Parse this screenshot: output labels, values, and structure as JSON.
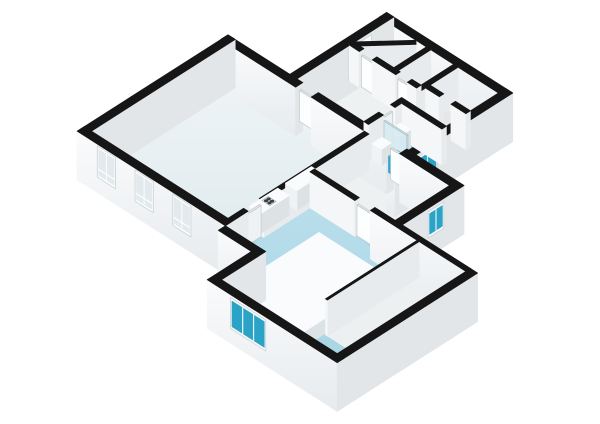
{
  "scene": {
    "w": 600,
    "h": 424,
    "origin": [
      228,
      80
    ],
    "ux": 13,
    "uy": 8.3,
    "wall_z": 36
  },
  "palette": {
    "cap": "#161616",
    "ext_u": "#e2e6e9",
    "ext_v": "@gext",
    "int_u": "#e7ebed",
    "int_v": "#f4f6f7",
    "furn_top": "#fafbfc",
    "furn_u": "#dde2e5",
    "furn_v": "#f0f3f4",
    "door_top": "#e8edef",
    "door_u": "#eef2f3",
    "door_v": "#fdfefe",
    "glass_top": "#d6e6ec",
    "glass_u": "rgba(196,223,233,0.9)",
    "glass_v": "rgba(214,234,241,0.9)",
    "teal_top": "#45b2cf",
    "teal_u": "#1d84a2",
    "teal_v": "#2ea7c9",
    "frame": "#fcfdfd",
    "frame_shade": "#c9d1d5",
    "glass_teal": "#2aa3c6",
    "glass_pale": "#e3eaed",
    "glass_bright": "#f7fafb",
    "floor_living": "@gliv",
    "floor_blue": "@gblue",
    "floor_hall": "#eef1f2",
    "floor_room": "#e4e8ea",
    "floor_room2": "#e9eced",
    "floor_bath": "#43acca",
    "floor_shower": "#66c0d8",
    "floor_closet": "#edf0f1",
    "stove_body": "#f2f4f4",
    "stove_dot": "#3a4043",
    "stove_edge": "#9aa4a8"
  },
  "floors": [
    {
      "n": "floor-living-room",
      "r": [
        0,
        0,
        10.5,
        10.5
      ],
      "f": "floor_living"
    },
    {
      "n": "floor-cluster-hall",
      "r": [
        4.75,
        -4.6,
        9.9,
        -0.55
      ],
      "f": "floor_hall"
    },
    {
      "n": "floor-room-topleft",
      "r": [
        4.75,
        -7.45,
        7.8,
        -4.95
      ],
      "f": "floor_room"
    },
    {
      "n": "floor-room-mid",
      "r": [
        8.15,
        -7.45,
        9.9,
        -4.95
      ],
      "f": "floor_room2"
    },
    {
      "n": "floor-closet-1",
      "r": [
        10.25,
        -7.45,
        13.35,
        -5.3
      ],
      "f": "floor_room"
    },
    {
      "n": "floor-closet-2",
      "r": [
        10.25,
        -4.95,
        13.35,
        -3.45
      ],
      "f": "floor_room2"
    },
    {
      "n": "floor-bathroom",
      "r": [
        10.25,
        -3.1,
        13.35,
        -0.55
      ],
      "f": "floor_bath"
    },
    {
      "n": "floor-shower",
      "r": [
        10.25,
        -3.1,
        13.35,
        -1.8
      ],
      "f": "floor_shower"
    },
    {
      "n": "floor-hallway-east",
      "r": [
        10.85,
        0,
        17.05,
        4.2
      ],
      "f": "floor_hall"
    },
    {
      "n": "floor-bedroom",
      "poly": [
        [
          10.85,
          4.55
        ],
        [
          22.85,
          4.55
        ],
        [
          22.85,
          14.45
        ],
        [
          13.95,
          14.45
        ],
        [
          13.95,
          11.05
        ],
        [
          10.85,
          11.05
        ]
      ],
      "f": "floor_blue"
    },
    {
      "n": "floor-closet-bedroom",
      "r": [
        19.25,
        4.55,
        22.85,
        11.6
      ],
      "f": "floor_closet"
    },
    {
      "n": "threshold",
      "r": [
        5.2,
        -0.55,
        6.4,
        0
      ],
      "f": "floor_hall"
    },
    {
      "n": "threshold",
      "r": [
        12.2,
        -0.55,
        13.2,
        0
      ],
      "f": "floor_bath"
    },
    {
      "n": "threshold",
      "r": [
        10.5,
        8.1,
        10.85,
        9.3
      ],
      "f": "floor_blue"
    },
    {
      "n": "threshold",
      "r": [
        14.3,
        4.2,
        15.5,
        4.55
      ],
      "f": "floor_blue"
    },
    {
      "n": "threshold",
      "r": [
        9.9,
        -2.6,
        10.25,
        -1.7
      ],
      "f": "floor_bath"
    },
    {
      "n": "threshold",
      "r": [
        5.5,
        -4.95,
        6.5,
        -4.6
      ],
      "f": "floor_hall"
    },
    {
      "n": "threshold",
      "r": [
        8.3,
        -4.95,
        9.2,
        -4.6
      ],
      "f": "floor_hall"
    },
    {
      "n": "threshold",
      "r": [
        11.3,
        -5.3,
        12.2,
        -4.95
      ],
      "f": "floor_room2"
    }
  ],
  "boxes": [
    {
      "n": "wall-north-living",
      "k": "ext",
      "r": [
        -0.55,
        -0.55,
        5.2,
        0
      ],
      "zb": -0.35
    },
    {
      "n": "wall-north-living-2",
      "k": "ext",
      "r": [
        6.4,
        -0.55,
        12.2,
        0
      ],
      "zb": -0.35
    },
    {
      "n": "wall-north-east",
      "k": "ext",
      "r": [
        13.2,
        -0.55,
        17.6,
        0
      ],
      "zb": -0.35
    },
    {
      "n": "wall-west-living",
      "k": "ext",
      "r": [
        -0.55,
        -0.55,
        0,
        11.05
      ],
      "zb": -0.35
    },
    {
      "n": "wall-south-living",
      "k": "ext",
      "r": [
        -0.55,
        10.5,
        10.85,
        11.05
      ],
      "zb": -0.35,
      "decals": [
        {
          "t": "win",
          "pl": "v",
          "at": 11.05,
          "a": [
            1.0,
            2.4
          ],
          "z": [
            0.08,
            0.95
          ],
          "g": "glass_pale",
          "panes": 2,
          "rail": 1
        },
        {
          "t": "win",
          "pl": "v",
          "at": 11.05,
          "a": [
            3.9,
            5.3
          ],
          "z": [
            0.08,
            0.95
          ],
          "g": "glass_pale",
          "panes": 2,
          "rail": 1
        },
        {
          "t": "win",
          "pl": "v",
          "at": 11.05,
          "a": [
            6.8,
            8.2
          ],
          "z": [
            0.08,
            0.95
          ],
          "g": "glass_pale",
          "panes": 2,
          "rail": 1
        }
      ]
    },
    {
      "n": "wall-east-living",
      "k": "int",
      "r": [
        10.5,
        0,
        10.85,
        8.1
      ]
    },
    {
      "n": "wall-east-living-2",
      "k": "int",
      "r": [
        10.5,
        9.3,
        10.85,
        11.05
      ]
    },
    {
      "n": "wall-cluster-north",
      "k": "ext",
      "r": [
        4.2,
        -8,
        13.9,
        -7.45
      ],
      "zb": -0.35
    },
    {
      "n": "wall-cluster-west",
      "k": "ext",
      "r": [
        4.2,
        -8,
        4.75,
        0
      ],
      "zb": -0.35,
      "decals": [
        {
          "t": "win",
          "pl": "u",
          "at": 4.75,
          "a": [
            -6.3,
            -4.5
          ],
          "z": [
            0.05,
            0.9
          ],
          "g": "glass_bright",
          "panes": 2
        }
      ]
    },
    {
      "n": "wall-cluster-east",
      "k": "ext",
      "r": [
        13.35,
        -8,
        13.9,
        1.1
      ],
      "zb": -0.35,
      "decals": [
        {
          "t": "win",
          "pl": "u",
          "at": 13.9,
          "a": [
            -2.2,
            -0.7
          ],
          "z": [
            0.18,
            0.9
          ],
          "g": "glass_teal",
          "panes": 2
        }
      ]
    },
    {
      "n": "wall-hall-east",
      "k": "ext",
      "r": [
        17.05,
        0,
        17.6,
        4.2
      ],
      "zb": -0.35,
      "decals": [
        {
          "t": "win",
          "pl": "u",
          "at": 17.6,
          "a": [
            1.0,
            2.2
          ],
          "z": [
            0.18,
            0.9
          ],
          "g": "glass_teal",
          "panes": 2
        }
      ]
    },
    {
      "n": "wall-bedroom-north",
      "k": "int",
      "r": [
        10.85,
        4.2,
        14.3,
        4.55
      ]
    },
    {
      "n": "wall-bedroom-north-2",
      "k": "ext",
      "r": [
        15.5,
        4.2,
        22.85,
        4.55
      ],
      "zb": -0.35
    },
    {
      "n": "wall-bedroom-east",
      "k": "ext",
      "r": [
        22.85,
        4.2,
        23.4,
        15
      ],
      "zb": -0.35
    },
    {
      "n": "wall-bedroom-south",
      "k": "ext",
      "r": [
        13.4,
        14.45,
        23.4,
        15
      ],
      "zb": -0.35,
      "decals": [
        {
          "t": "win",
          "pl": "v",
          "at": 15,
          "a": [
            15.2,
            17.9
          ],
          "z": [
            0.06,
            0.92
          ],
          "g": "glass_teal",
          "panes": 3
        }
      ]
    },
    {
      "n": "wall-step-south",
      "k": "ext",
      "r": [
        10.85,
        11.05,
        13.95,
        11.6
      ],
      "zb": -0.35
    },
    {
      "n": "wall-step-west",
      "k": "ext",
      "r": [
        13.4,
        11.6,
        13.95,
        14.45
      ],
      "zb": -0.35
    },
    {
      "n": "wall-closet-a",
      "k": "int",
      "r": [
        7.8,
        -7.45,
        8.15,
        -4.95
      ]
    },
    {
      "n": "wall-diagonal",
      "k": "int",
      "poly": [
        [
          4.75,
          -5.0
        ],
        [
          7.0,
          -7.45
        ],
        [
          7.26,
          -7.21
        ],
        [
          5.01,
          -4.76
        ]
      ]
    },
    {
      "n": "wall-closet-b1",
      "k": "int",
      "r": [
        4.75,
        -4.95,
        5.5,
        -4.6
      ]
    },
    {
      "n": "wall-closet-b2",
      "k": "int",
      "r": [
        6.5,
        -4.95,
        8.3,
        -4.6
      ]
    },
    {
      "n": "wall-closet-b3",
      "k": "int",
      "r": [
        9.2,
        -4.95,
        9.9,
        -4.6
      ]
    },
    {
      "n": "wall-closet-c",
      "k": "int",
      "r": [
        9.9,
        -7.45,
        10.25,
        -3.45
      ]
    },
    {
      "n": "wall-closet-d1",
      "k": "int",
      "r": [
        10.25,
        -5.3,
        11.3,
        -4.95
      ]
    },
    {
      "n": "wall-closet-d2",
      "k": "int",
      "r": [
        12.2,
        -5.3,
        13.35,
        -4.95
      ]
    },
    {
      "n": "wall-bath-north",
      "k": "int",
      "r": [
        9.9,
        -3.45,
        13.35,
        -3.1
      ]
    },
    {
      "n": "wall-bath-west-1",
      "k": "int",
      "r": [
        9.9,
        -3.1,
        10.25,
        -2.6
      ]
    },
    {
      "n": "wall-bath-west-2",
      "k": "int",
      "r": [
        9.9,
        -1.7,
        10.25,
        -0.55
      ]
    },
    {
      "n": "door-living-hall",
      "k": "door",
      "r": [
        5.25,
        -0.38,
        6.35,
        -0.26
      ],
      "h": 0.86
    },
    {
      "n": "door-hall-bath",
      "k": "door",
      "r": [
        12.25,
        -0.38,
        13.15,
        -0.26
      ],
      "h": 0.86
    },
    {
      "n": "door-closet-1",
      "k": "door",
      "r": [
        5.55,
        -4.84,
        6.45,
        -4.72
      ],
      "h": 0.86
    },
    {
      "n": "door-closet-2",
      "k": "door",
      "r": [
        8.35,
        -4.84,
        9.15,
        -4.72
      ],
      "h": 0.86
    },
    {
      "n": "door-bathroom",
      "k": "door",
      "r": [
        10.0,
        -2.55,
        10.12,
        -1.75
      ],
      "h": 0.86
    },
    {
      "n": "door-living-bedroom",
      "k": "door",
      "r": [
        10.58,
        8.15,
        10.7,
        9.25
      ],
      "h": 0.86
    },
    {
      "n": "door-hall-bedroom",
      "k": "door",
      "r": [
        14.35,
        4.31,
        15.45,
        4.43
      ],
      "h": 0.86
    },
    {
      "n": "kitchen-counter",
      "k": "furn",
      "r": [
        9.62,
        3.2,
        10.5,
        5.2
      ],
      "h": 0.55
    },
    {
      "n": "kitchen-counter-stove",
      "k": "furn",
      "r": [
        9.62,
        5.8,
        10.5,
        8.0
      ],
      "h": 0.55,
      "decals": [
        {
          "t": "stove",
          "at": [
            10.06,
            6.9
          ],
          "z": 0.55
        }
      ]
    },
    {
      "n": "kitchen-cabinet",
      "k": "furn",
      "r": [
        9.62,
        8.7,
        10.5,
        10.15
      ],
      "h": 0.55
    },
    {
      "n": "toilet",
      "k": "furn",
      "r": [
        10.35,
        -1.5,
        11.05,
        -0.75
      ],
      "h": 0.45
    },
    {
      "n": "shower-unit",
      "k": "furn",
      "r": [
        10.3,
        -2.95,
        11.1,
        -2.05
      ],
      "h": 0.5
    },
    {
      "n": "shower-glass",
      "k": "glass",
      "r": [
        10.25,
        -1.85,
        12.0,
        -1.75
      ],
      "h": 0.82
    },
    {
      "n": "bathroom-sink-teal",
      "k": "teal",
      "r": [
        11.75,
        -1.3,
        12.45,
        -0.6
      ],
      "h": 0.45
    },
    {
      "n": "bathroom-vanity",
      "k": "furn",
      "r": [
        12.55,
        -1.35,
        13.3,
        -0.6
      ],
      "h": 0.5
    },
    {
      "n": "bed-platform",
      "k": "furn",
      "r": [
        13.6,
        6.6,
        19.0,
        14.0
      ],
      "h": 0.42
    },
    {
      "n": "closet-partition",
      "k": "int",
      "r": [
        19.1,
        4.55,
        19.25,
        11.6
      ]
    }
  ]
}
